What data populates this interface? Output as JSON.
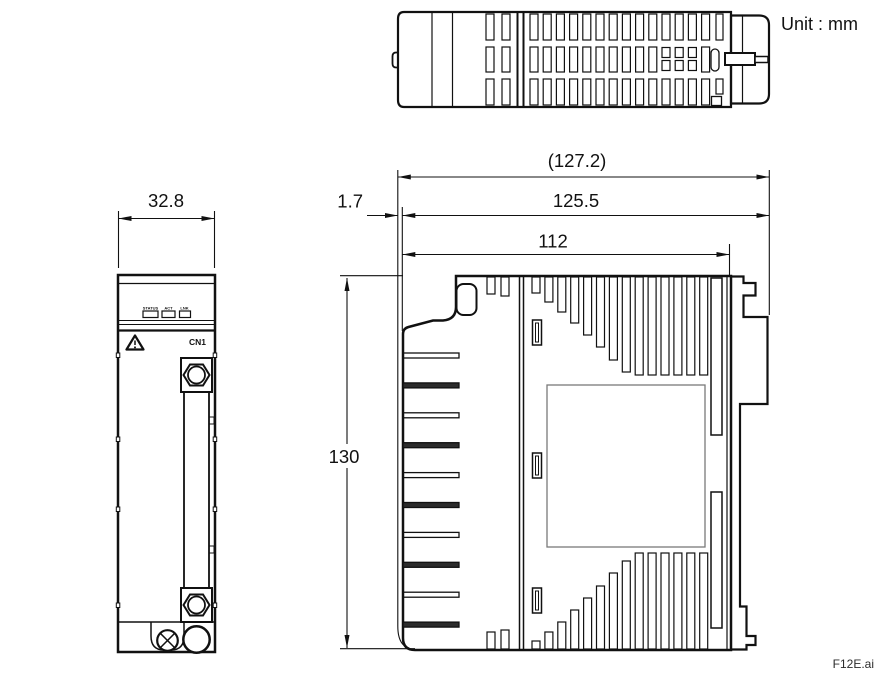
{
  "drawing": {
    "unit_label": "Unit : mm",
    "file_label": "F12E.ai"
  },
  "front_view": {
    "width_dim": "32.8",
    "connector_label": "CN1",
    "led_labels": [
      "STATUS",
      "ACT",
      "LNK"
    ]
  },
  "side_view": {
    "overall_width_dim": "(127.2)",
    "body_width_dim": "125.5",
    "depth_dim": "112",
    "offset_dim": "1.7",
    "height_dim": "130"
  }
}
